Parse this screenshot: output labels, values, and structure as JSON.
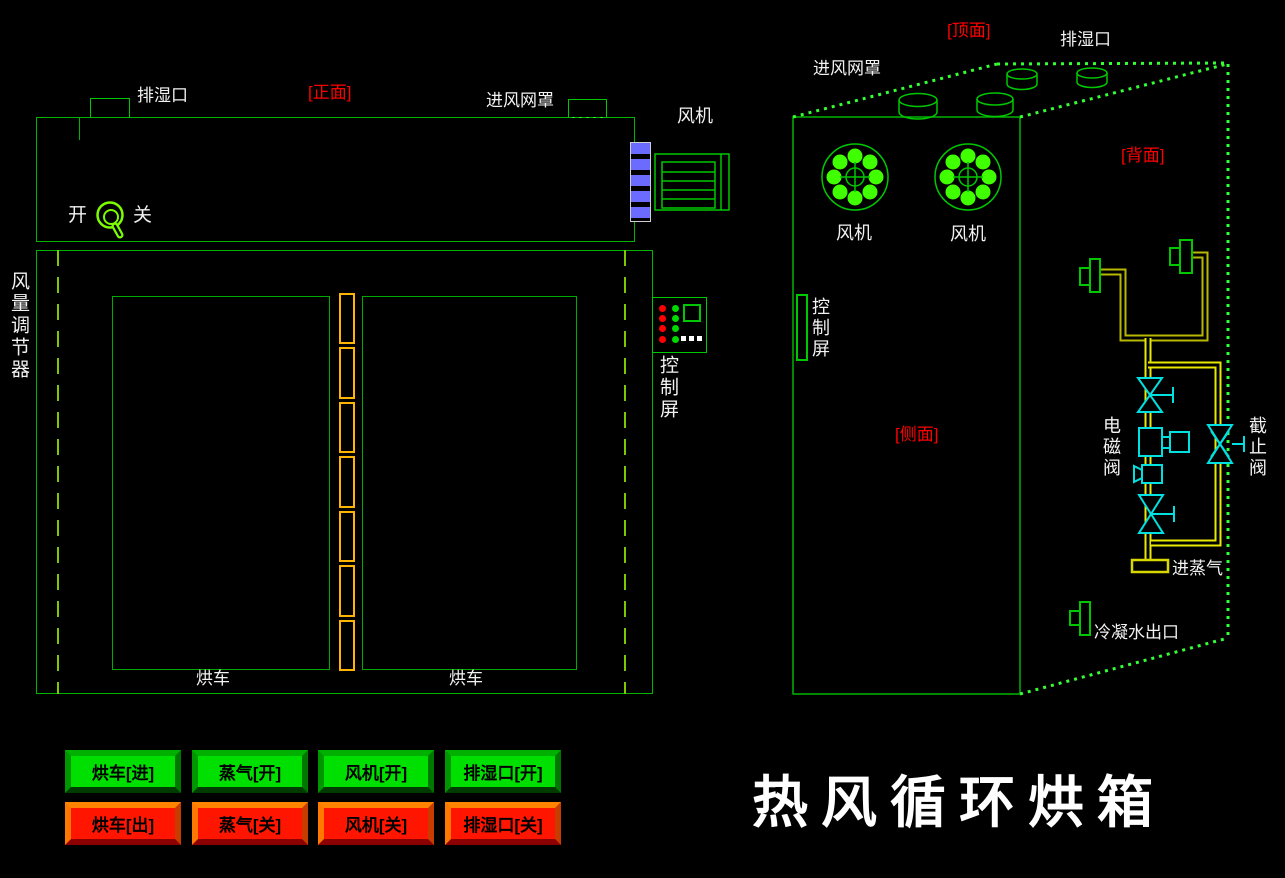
{
  "title": "热风循环烘箱",
  "front_view": {
    "section_label": "[正面]",
    "exhaust_port_label": "排湿口",
    "inlet_mesh_label": "进风网罩",
    "fan_label": "风机",
    "switch_on_label": "开",
    "switch_off_label": "关",
    "air_regulator_label": "风量调节器",
    "control_screen_label": "控制屏",
    "cart_labels": [
      "烘车",
      "烘车"
    ]
  },
  "side_view": {
    "top_face_label": "[顶面]",
    "back_face_label": "[背面]",
    "side_face_label": "[侧面]",
    "inlet_mesh_label": "进风网罩",
    "exhaust_port_label": "排湿口",
    "fan_labels": [
      "风机",
      "风机"
    ],
    "control_screen_label": "控制屏",
    "solenoid_valve_label": "电磁阀",
    "stop_valve_label": "截止阀",
    "steam_inlet_label": "进蒸气",
    "condensate_outlet_label": "冷凝水出口"
  },
  "buttons": [
    {
      "label": "烘车[进]",
      "state": "green"
    },
    {
      "label": "蒸气[开]",
      "state": "green"
    },
    {
      "label": "风机[开]",
      "state": "green"
    },
    {
      "label": "排湿口[开]",
      "state": "green"
    },
    {
      "label": "烘车[出]",
      "state": "red"
    },
    {
      "label": "蒸气[关]",
      "state": "red"
    },
    {
      "label": "风机[关]",
      "state": "red"
    },
    {
      "label": "排湿口[关]",
      "state": "red"
    }
  ],
  "colors": {
    "background": "#000000",
    "line_green": "#00b400",
    "bright_green": "#33ff33",
    "dashed_lime": "#7dc800",
    "hinge_yellow": "#ffb400",
    "pipe_dark_yellow": "#b8b800",
    "pipe_bright_yellow": "#e8e800",
    "valve_cyan": "#00e0e0",
    "louver_blue": "#6b6bff",
    "label_red": "#ff0000",
    "button_green": "#00e000",
    "button_red": "#ff1500"
  }
}
